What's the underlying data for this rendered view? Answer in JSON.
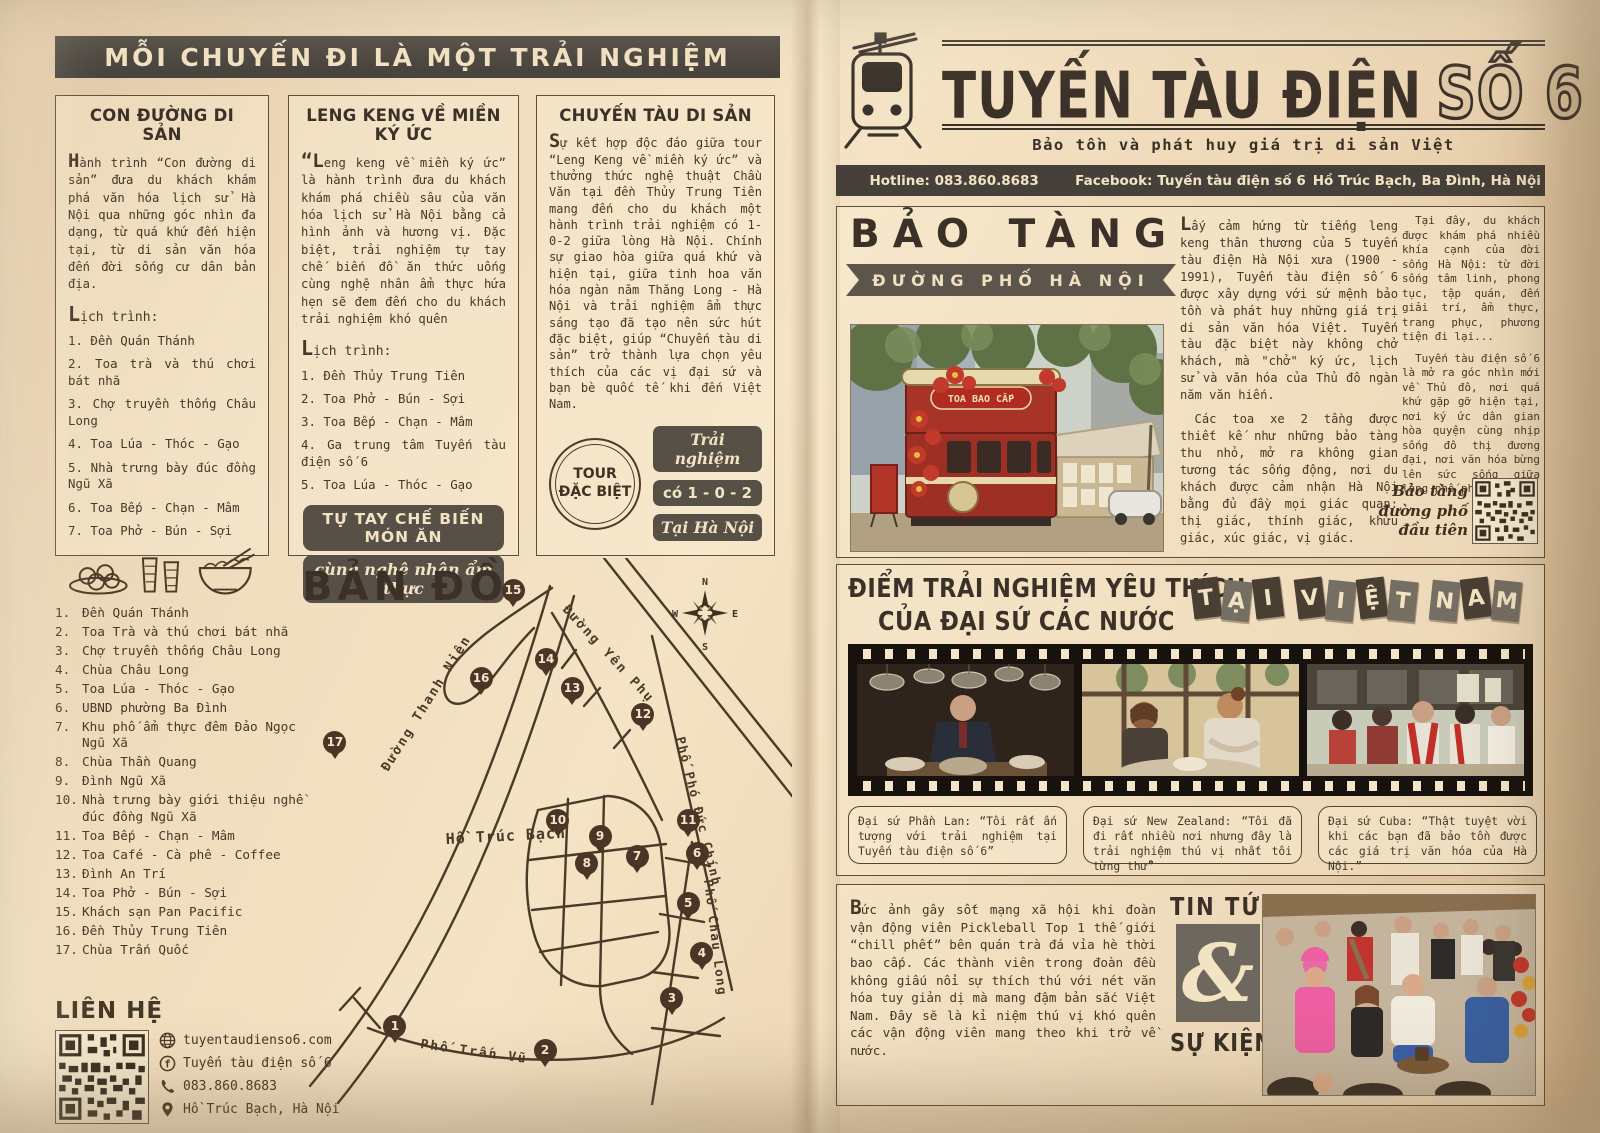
{
  "colors": {
    "paper": "#f2e3c4",
    "ink": "#463828",
    "banner_dark": "#45403a",
    "badge_dark": "#565047",
    "pin_brown": "#4a3527",
    "tram_red": "#a83327",
    "cream": "#f2e3c2"
  },
  "left_page": {
    "banner": "MỖI CHUYẾN ĐI LÀ MỘT TRẢI NGHIỆM",
    "columns": [
      {
        "title": "CON ĐƯỜNG DI SẢN",
        "intro": "Hành trình “Con đường di sản” đưa du khách khám phá văn hóa lịch sử Hà Nội qua những góc nhìn đa dạng, từ quá khứ đến hiện tại, từ di sản văn hóa đến đời sống cư dân bản địa.",
        "schedule_label": "Lịch trình:",
        "items": [
          "1. Đền Quán Thánh",
          "2. Toa trà và thú chơi bát nhã",
          "3. Chợ truyền thống Châu Long",
          "4. Toa Lúa - Thóc - Gạo",
          "5. Nhà trưng bày đúc đồng Ngũ Xã",
          "6. Toa Bếp - Chạn - Mâm",
          "7. Toa Phở - Bún - Sợi"
        ],
        "icons": [
          "plate-of-cakes-icon",
          "iced-tea-glasses-icon",
          "pho-bowl-icon"
        ]
      },
      {
        "title": "LENG KENG VỀ MIỀN KÝ ỨC",
        "intro": "“Leng keng về miền ký ức” là hành trình đưa du khách khám phá chiều sâu của văn hóa lịch sử Hà Nội bằng cả hình ảnh và hương vị. Đặc biệt, trải nghiệm tự tay chế biến đồ ăn thức uống cùng nghệ nhân ẩm thực hứa hẹn sẽ đem đến cho du khách trải nghiệm khó quên",
        "schedule_label": "Lịch trình:",
        "items": [
          "1. Đền Thủy Trung Tiên",
          "2. Toa Phở - Bún - Sợi",
          "3. Toa Bếp - Chạn - Mâm",
          "4. Ga trung tâm Tuyến tàu điện số 6",
          "5. Toa Lúa - Thóc - Gạo"
        ],
        "badge1": "TỰ TAY CHẾ BIẾN MÓN ĂN",
        "badge2": "cùng nghệ nhân ẩm thực"
      },
      {
        "title": "CHUYẾN TÀU DI SẢN",
        "intro": "Sự kết hợp độc đáo giữa tour “Leng Keng về miền ký ức” và thưởng thức nghệ thuật Chầu Văn tại đền Thủy Trung Tiên mang đến cho du khách một hành trình trải nghiệm có 1-0-2 giữa lòng Hà Nội. Chính sự giao hòa giữa quá khứ và hiện tại, giữa tinh hoa văn hóa ngàn năm Thăng Long - Hà Nội và trải nghiệm ẩm thực sáng tạo đã tạo nên sức hút đặc biệt, giúp “Chuyến tàu di sản” trở thành lựa chọn yêu thích của các vị đại sứ và bạn bè quốc tế khi đến Việt Nam.",
        "stamp_line1": "TOUR",
        "stamp_line2": "ĐẶC BIỆT",
        "badges": [
          "Trải nghiệm",
          "có 1 - 0 - 2",
          "Tại Hà Nội"
        ]
      }
    ],
    "map": {
      "title": "BẢN ĐỒ",
      "legend": [
        {
          "n": "1.",
          "t": "Đền Quán Thánh"
        },
        {
          "n": "2.",
          "t": "Toa Trà và thú chơi bát nhã"
        },
        {
          "n": "3.",
          "t": "Chợ truyền thống Châu Long"
        },
        {
          "n": "4.",
          "t": "Chùa Châu Long"
        },
        {
          "n": "5.",
          "t": "Toa Lúa - Thóc - Gạo"
        },
        {
          "n": "6.",
          "t": "UBND phường Ba Đình"
        },
        {
          "n": "7.",
          "t": "Khu phố ẩm thực đêm Đảo Ngọc Ngũ Xã"
        },
        {
          "n": "8.",
          "t": "Chùa Thần Quang"
        },
        {
          "n": "9.",
          "t": "Đình Ngũ Xã"
        },
        {
          "n": "10.",
          "t": "Nhà trưng bày giới thiệu nghề đúc đồng Ngũ Xã"
        },
        {
          "n": "11.",
          "t": "Toa Bếp - Chạn - Mâm"
        },
        {
          "n": "12.",
          "t": "Toa Café - Cà phê - Coffee"
        },
        {
          "n": "13.",
          "t": "Đình An Trí"
        },
        {
          "n": "14.",
          "t": "Toa Phở - Bún - Sợi"
        },
        {
          "n": "15.",
          "t": "Khách sạn Pan Pacific"
        },
        {
          "n": "16.",
          "t": "Đền Thủy Trung Tiên"
        },
        {
          "n": "17.",
          "t": "Chùa Trấn Quốc"
        }
      ],
      "streets": [
        "Đường Thanh Niên",
        "Đường Yên Phụ",
        "Phố Phó Đức Chính",
        "Phố Châu Long",
        "Phố Trấn Vũ"
      ],
      "lake_label": "Hồ Trúc Bạch",
      "compass": {
        "n": "N",
        "w": "W",
        "e": "E",
        "s": "S"
      },
      "markers": [
        {
          "n": 1,
          "x": 19.3,
          "y": 85.9
        },
        {
          "n": 2,
          "x": 49.8,
          "y": 90.3
        },
        {
          "n": 3,
          "x": 75.6,
          "y": 80.8
        },
        {
          "n": 4,
          "x": 81.7,
          "y": 72.6
        },
        {
          "n": 5,
          "x": 78.9,
          "y": 63.4
        },
        {
          "n": 6,
          "x": 80.7,
          "y": 54.3
        },
        {
          "n": 7,
          "x": 68.5,
          "y": 54.8
        },
        {
          "n": 8,
          "x": 58.3,
          "y": 56.1
        },
        {
          "n": 9,
          "x": 61.0,
          "y": 51.2
        },
        {
          "n": 10,
          "x": 52.4,
          "y": 48.3
        },
        {
          "n": 11,
          "x": 78.9,
          "y": 48.3
        },
        {
          "n": 12,
          "x": 69.7,
          "y": 28.9
        },
        {
          "n": 13,
          "x": 55.3,
          "y": 24.1
        },
        {
          "n": 14,
          "x": 50.0,
          "y": 18.8
        },
        {
          "n": 15,
          "x": 43.3,
          "y": 6.2
        },
        {
          "n": 16,
          "x": 36.8,
          "y": 22.3
        },
        {
          "n": 17,
          "x": 7.1,
          "y": 34.0
        }
      ]
    },
    "contact": {
      "title": "LIÊN HỆ",
      "website": "tuyentaudienso6.com",
      "facebook": "Tuyến tàu điện số 6",
      "phone": "083.860.8683",
      "address": "Hồ Trúc Bạch, Hà Nội"
    }
  },
  "right_page": {
    "masthead": {
      "title": "TUYẾN TÀU ĐIỆN",
      "title_suffix": "SỐ 6",
      "tagline": "Bảo tồn và phát huy giá trị di sản Việt",
      "infobar": {
        "hotline": "Hotline: 083.860.8683",
        "facebook": "Facebook: Tuyến tàu điện số 6",
        "address": "Hồ Trúc Bạch, Ba Đình, Hà Nội"
      }
    },
    "museum": {
      "headline": "BẢO TÀNG",
      "ribbon": "ĐƯỜNG PHỐ HÀ NỘI",
      "photo_sign": "TOA BAO CẤP",
      "col1": [
        "Lấy cảm hứng từ tiếng leng keng thân thương của 5 tuyến tàu điện Hà Nội xưa (1900 - 1991), Tuyến tàu điện số 6 được xây dựng với sứ mệnh bảo tồn và phát huy những giá trị di sản văn hóa Việt. Tuyến tàu đặc biệt này không chở khách, mà \"chở\" ký ức, lịch sử và văn hóa của Thủ đô ngàn năm văn hiến.",
        "Các toa xe 2 tầng được thiết kế như những bảo tàng thu nhỏ, mở ra không gian tương tác sống động, nơi du khách được cảm nhận Hà Nội bằng đủ đầy mọi giác quan: thị giác, thính giác, khứu giác, xúc giác, vị giác."
      ],
      "col2": [
        "Tại đây, du khách được khám phá nhiều khía cạnh của đời sống Hà Nội: từ đời sống tâm linh, phong tục, tập quán, đến giải trí, ẩm thực, trang phục, phương tiện đi lại...",
        "Tuyến tàu điện số 6 là mở ra góc nhìn mới về Thủ đô, nơi quá khứ gặp gỡ hiện tại, nơi ký ức dân gian hòa quyện cùng nhịp sống đô thị đương đại, nơi văn hóa bừng lên sức sống giữa lòng phố phường."
      ],
      "qr_caption": "Bảo tàng đường phố đầu tiên"
    },
    "experience": {
      "heading_line1": "ĐIỂM TRẢI NGHIỆM YÊU THÍCH",
      "heading_line2": "CỦA ĐẠI SỨ CÁC NƯỚC",
      "tiles": [
        "T",
        "Ạ",
        "I",
        "",
        "V",
        "I",
        "Ệ",
        "T",
        "",
        "N",
        "A",
        "M"
      ],
      "quotes": [
        "Đại sứ Phần Lan: “Tôi rất ấn tượng với trải nghiệm tại Tuyến tàu điện số 6”",
        "Đại sứ New Zealand: “Tôi đã đi rất nhiều nơi nhưng đây là trải nghiệm thú vị nhất tôi từng thử”",
        "Đại sứ Cuba: “Thật tuyệt vời khi các bạn đã bảo tồn được các giá trị văn hóa của Hà Nội.”"
      ]
    },
    "news": {
      "title_top": "TIN TỨC",
      "ampersand": "&",
      "title_bottom": "SỰ KIỆN",
      "body": "Bức ảnh gây sốt mạng xã hội khi đoàn vận động viên Pickleball Top 1 thế giới “chill phết” bên quán trà đá vỉa hè thời bao cấp. Các thành viên trong đoàn đều không giấu nổi sự thích thú với nét văn hóa tuy giản dị mà mang đậm bản sắc Việt Nam. Đây sẽ là kỉ niệm thú vị khó quên các vận động viên mang theo khi trở về nước."
    }
  }
}
